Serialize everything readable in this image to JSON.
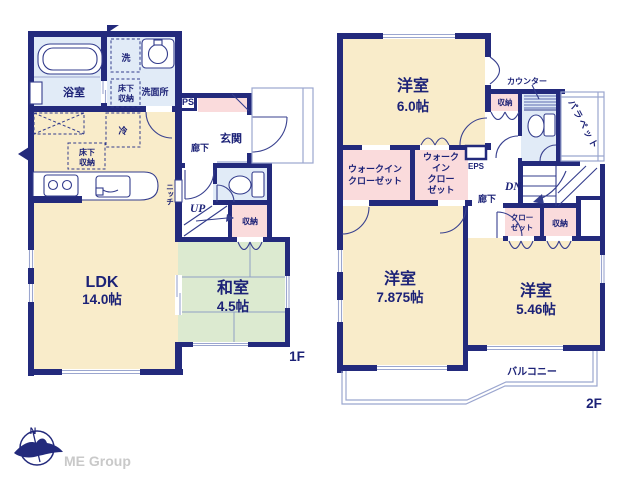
{
  "floor1": {
    "floor_label": "1F",
    "ldk": {
      "name": "LDK",
      "size": "14.0帖"
    },
    "washitsu": {
      "name": "和室",
      "size": "4.5帖"
    },
    "bath": "浴室",
    "washer": "洗",
    "underfloor_washroom": {
      "line1": "床下",
      "line2": "収納"
    },
    "washroom": "洗面所",
    "ps": "PS",
    "entrance": "玄関",
    "hallway": "廊下",
    "fridge": "冷",
    "underfloor_kitchen": {
      "line1": "床下",
      "line2": "収納"
    },
    "niche": "ニッチ",
    "up": "UP",
    "storage": "収納"
  },
  "floor2": {
    "floor_label": "2F",
    "bedroom1": {
      "name": "洋室",
      "size": "6.0帖"
    },
    "bedroom2": {
      "name": "洋室",
      "size": "7.875帖"
    },
    "bedroom3": {
      "name": "洋室",
      "size": "5.46帖"
    },
    "counter": "カウンター",
    "storage_top": "収納",
    "parapet": "パラペット",
    "wic_large": {
      "line1": "ウォークイン",
      "line2": "クローゼット"
    },
    "wic_small": {
      "line1": "ウォーク",
      "line2": "イン",
      "line3": "クロー",
      "line4": "ゼット"
    },
    "eps": "EPS",
    "dn": "DN",
    "hallway": "廊下",
    "closet": {
      "line1": "クロー",
      "line2": "ゼット"
    },
    "storage_hall": "収納",
    "balcony": "バルコニー"
  },
  "footer": {
    "brand": "ME Group",
    "compass_north": "N"
  },
  "colors": {
    "wall": "#232a7c",
    "text": "#1c2277",
    "room_cream": "#f9ecca",
    "room_pink": "#fadbdc",
    "room_green": "#dcead0",
    "room_blue": "#e1ebf7",
    "thin_line": "#333c8c",
    "light_line": "#9ba6cf",
    "brand_gray": "#c9c9c9"
  }
}
